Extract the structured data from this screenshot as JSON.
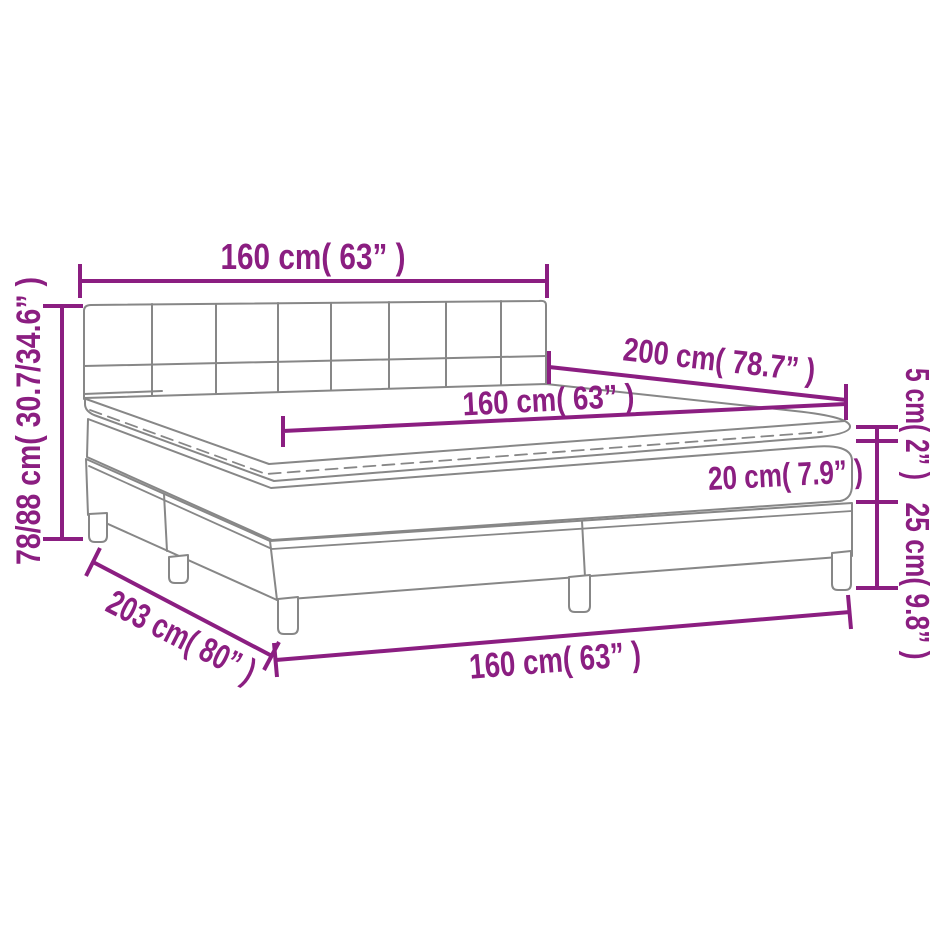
{
  "diagram": {
    "title": "Box spring bed with mattress and topper — dimension diagram",
    "colors": {
      "dimension_color": "#8B1E81",
      "outline_color": "#878787",
      "background": "#FFFFFF"
    },
    "labels": {
      "headboard_width": "160 cm( 63” )",
      "overall_height": "78/88 cm( 30.7/34.6” )",
      "bed_length": "200 cm( 78.7” )",
      "mattress_width": "160 cm( 63” )",
      "mattress_thickness": "20 cm( 7.9” )",
      "topper_thickness": "5 cm( 2” )",
      "base_height": "25 cm( 9.8” )",
      "overall_length": "203 cm( 80” )",
      "foot_width": "160 cm( 63” )"
    }
  }
}
